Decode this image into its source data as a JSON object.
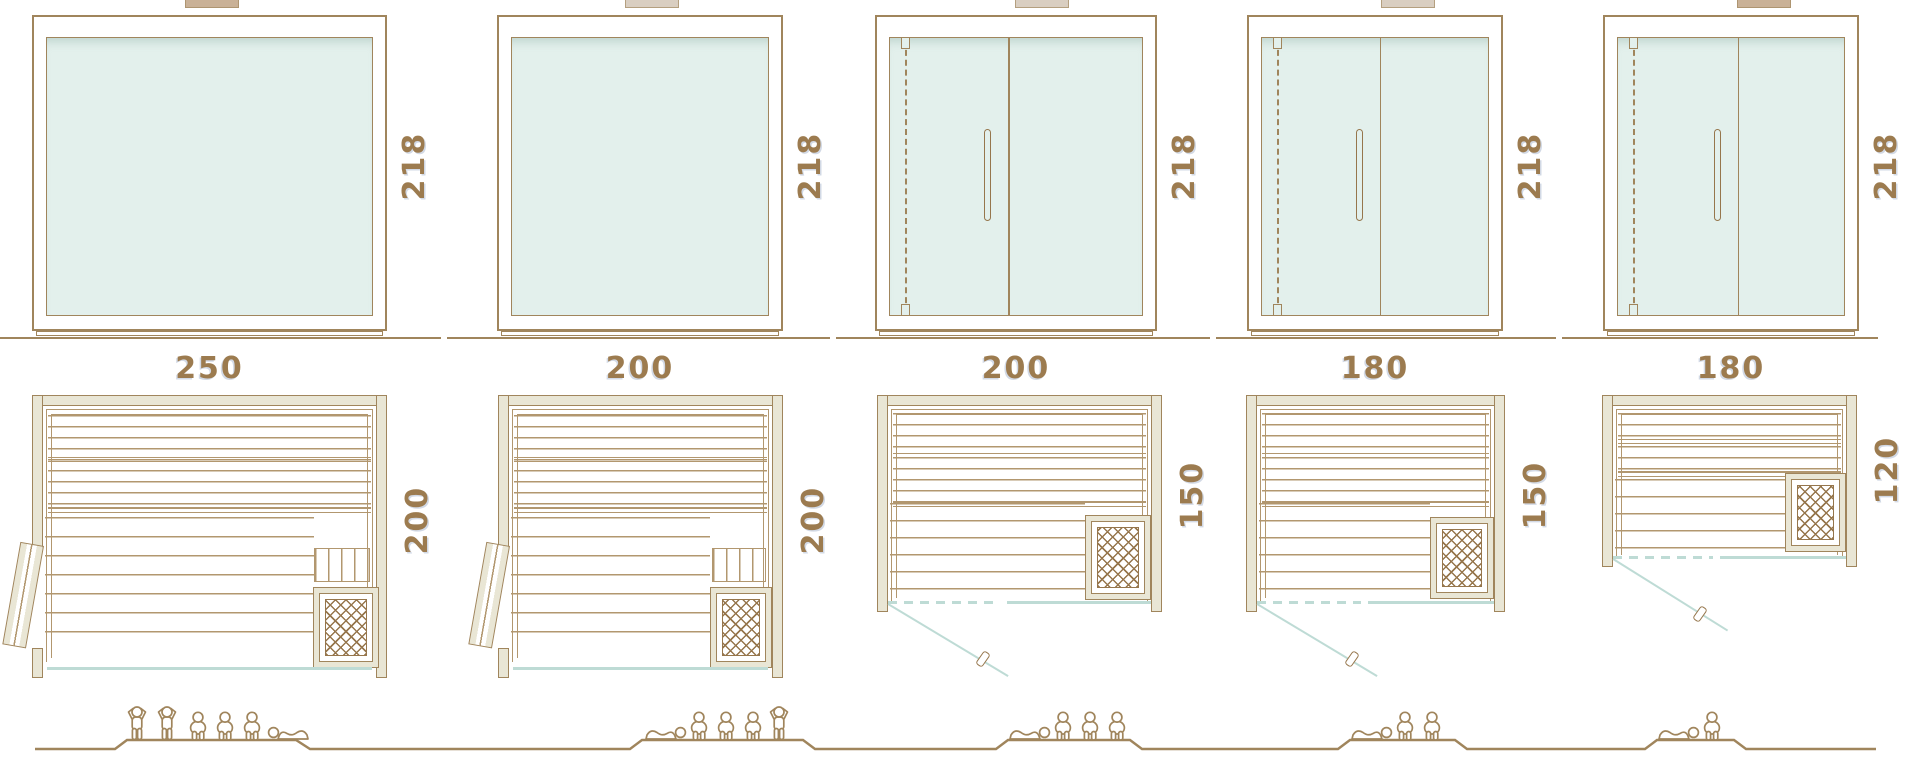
{
  "palette": {
    "line": "#a0855c",
    "line_soft": "#b2976f",
    "dimension_text": "#9c7b4f",
    "wall_fill": "#e9e6d5",
    "glass_fill": "#e3f0ec",
    "glass_line": "#bedbd5",
    "lattice": "#96764c"
  },
  "saunas": [
    {
      "name": "sauna-1",
      "width_label": "250",
      "height_label": "218",
      "depth_label": "200",
      "front_door_in_elevation": false,
      "plan_door": "side-hinged-left-open-leaf",
      "capacity_figures": [
        "standing",
        "standing",
        "sitting",
        "sitting",
        "sitting",
        "lying"
      ]
    },
    {
      "name": "sauna-2",
      "width_label": "200",
      "height_label": "218",
      "depth_label": "200",
      "front_door_in_elevation": false,
      "plan_door": "side-hinged-left-open-leaf",
      "capacity_figures": [
        "lying",
        "sitting",
        "sitting",
        "sitting",
        "standing"
      ]
    },
    {
      "name": "sauna-3",
      "width_label": "200",
      "height_label": "218",
      "depth_label": "150",
      "front_door_in_elevation": true,
      "plan_door": "front-glass-swing",
      "capacity_figures": [
        "lying",
        "sitting",
        "sitting",
        "sitting"
      ]
    },
    {
      "name": "sauna-4",
      "width_label": "180",
      "height_label": "218",
      "depth_label": "150",
      "front_door_in_elevation": true,
      "plan_door": "front-glass-swing",
      "capacity_figures": [
        "lying",
        "sitting",
        "sitting"
      ]
    },
    {
      "name": "sauna-5",
      "width_label": "180",
      "height_label": "218",
      "depth_label": "120",
      "front_door_in_elevation": true,
      "plan_door": "front-glass-swing",
      "capacity_figures": [
        "lying",
        "sitting"
      ]
    }
  ]
}
